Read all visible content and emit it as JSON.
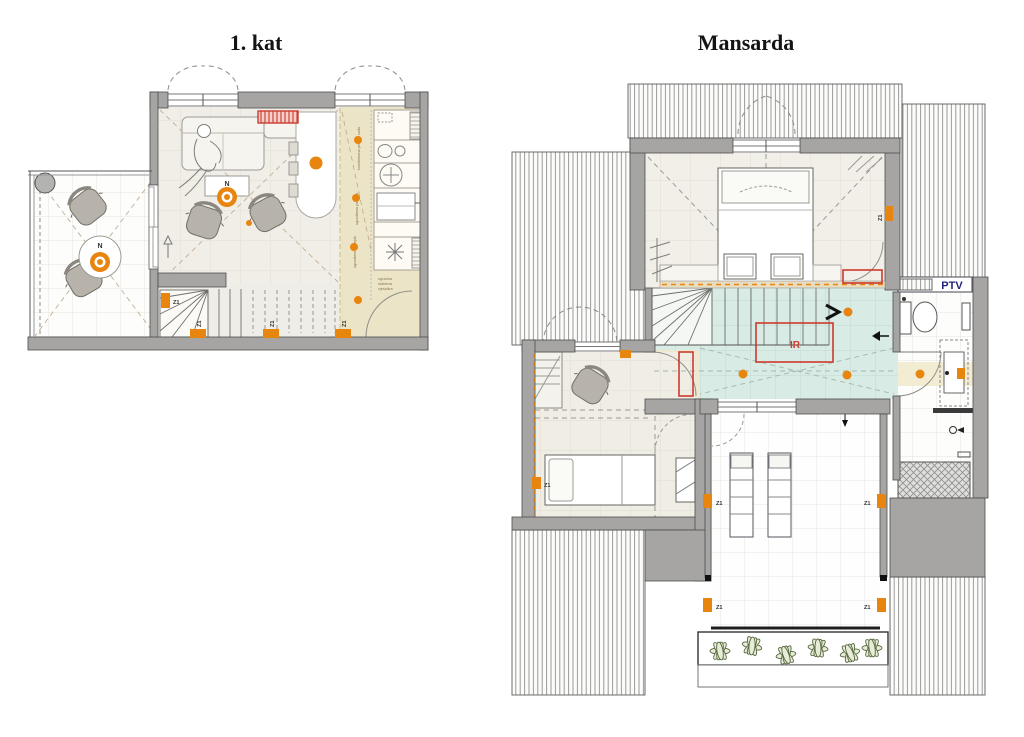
{
  "plans": {
    "first_floor": {
      "title": "1. kat"
    },
    "attic": {
      "title": "Mansarda"
    }
  },
  "labels": {
    "north": "N",
    "zone_marker": "Z1",
    "infrared_panel": "IR",
    "water_heater": "PTV"
  },
  "kitchen_annotations": {
    "appliance_1": "kombinirana perilica suđa",
    "appliance_2": "ugradbena pećnica",
    "appliance_3": "ugradbeni hladnjak",
    "corner_note_1": "ugradna",
    "corner_note_2": "staklena",
    "corner_note_3": "vješalica"
  },
  "colors": {
    "wall": "#a6a5a3",
    "accent_orange": "#e8850f",
    "accent_red": "#cc3a2e",
    "ptv_text": "#24247e",
    "teal_floor": "#d9ebe5",
    "kitchen_floor": "#ece4c6",
    "nook_floor": "#efe8d0"
  }
}
